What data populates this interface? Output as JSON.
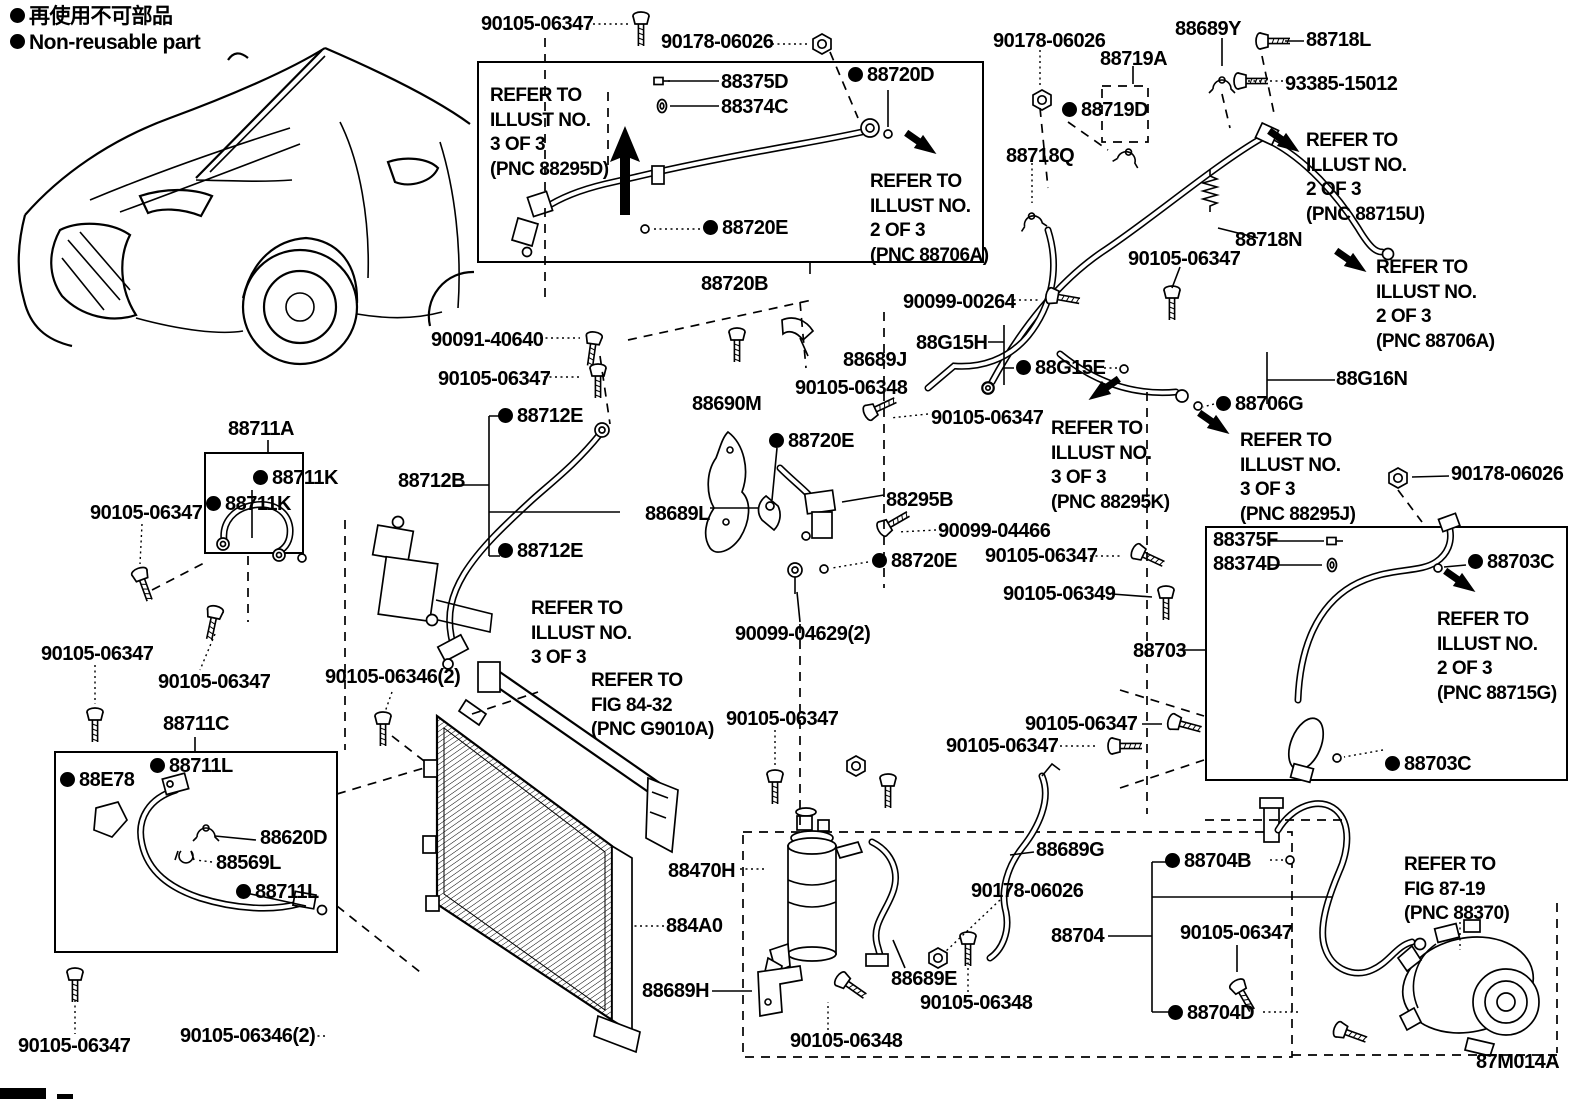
{
  "figure": {
    "figure_code": "87M014A",
    "description_visible": false
  },
  "colors": {
    "ink": "#000000",
    "paper": "#ffffff"
  },
  "legend": {
    "marker": "non-reusable-dot",
    "jp": "再使用不可部品",
    "en": "Non-reusable part"
  },
  "labels": [
    {
      "t": "再使用不可部品",
      "x": 10,
      "y": 6,
      "b": 1,
      "s": 21,
      "k": "legend-jp"
    },
    {
      "t": "Non-reusable part",
      "x": 10,
      "y": 32,
      "b": 1,
      "s": 21,
      "k": "legend-en"
    },
    {
      "t": "90105-06347",
      "x": 481,
      "y": 14
    },
    {
      "t": "90178-06026",
      "x": 661,
      "y": 32
    },
    {
      "t": "REFER TO\nILLUST NO.\n3 OF 3\n(PNC 88295D)",
      "x": 490,
      "y": 84,
      "m": 1,
      "s": 19,
      "k": "refer-note"
    },
    {
      "t": "88375D",
      "x": 721,
      "y": 72
    },
    {
      "t": "88374C",
      "x": 721,
      "y": 97
    },
    {
      "t": "88720D",
      "x": 848,
      "y": 65,
      "b": 1
    },
    {
      "t": "88720E",
      "x": 703,
      "y": 218,
      "b": 1
    },
    {
      "t": "REFER TO\nILLUST NO.\n2 OF 3\n(PNC 88706A)",
      "x": 870,
      "y": 170,
      "m": 1,
      "s": 19,
      "k": "refer-note"
    },
    {
      "t": "88720B",
      "x": 701,
      "y": 274
    },
    {
      "t": "90178-06026",
      "x": 993,
      "y": 31
    },
    {
      "t": "88719A",
      "x": 1100,
      "y": 49
    },
    {
      "t": "88719D",
      "x": 1062,
      "y": 100,
      "b": 1
    },
    {
      "t": "88689Y",
      "x": 1175,
      "y": 19
    },
    {
      "t": "88718L",
      "x": 1306,
      "y": 30
    },
    {
      "t": "93385-15012",
      "x": 1285,
      "y": 74
    },
    {
      "t": "88718Q",
      "x": 1006,
      "y": 146
    },
    {
      "t": "REFER TO\nILLUST NO.\n2 OF 3\n(PNC 88715U)",
      "x": 1306,
      "y": 129,
      "m": 1,
      "s": 19,
      "k": "refer-note"
    },
    {
      "t": "88718N",
      "x": 1235,
      "y": 230
    },
    {
      "t": "90105-06347",
      "x": 1128,
      "y": 249
    },
    {
      "t": "REFER TO\nILLUST NO.\n2 OF 3\n(PNC 88706A)",
      "x": 1376,
      "y": 256,
      "m": 1,
      "s": 19,
      "k": "refer-note"
    },
    {
      "t": "90099-00264",
      "x": 903,
      "y": 292
    },
    {
      "t": "90091-40640",
      "x": 431,
      "y": 330
    },
    {
      "t": "90105-06347",
      "x": 438,
      "y": 369
    },
    {
      "t": "88711A",
      "x": 228,
      "y": 419
    },
    {
      "t": "88711K",
      "x": 253,
      "y": 468,
      "b": 1
    },
    {
      "t": "88711K",
      "x": 206,
      "y": 494,
      "b": 1
    },
    {
      "t": "90105-06347",
      "x": 90,
      "y": 503
    },
    {
      "t": "88712B",
      "x": 398,
      "y": 471
    },
    {
      "t": "88712E",
      "x": 498,
      "y": 406,
      "b": 1
    },
    {
      "t": "88712E",
      "x": 498,
      "y": 541,
      "b": 1
    },
    {
      "t": "88690M",
      "x": 692,
      "y": 394
    },
    {
      "t": "88720E",
      "x": 769,
      "y": 431,
      "b": 1
    },
    {
      "t": "88689J",
      "x": 843,
      "y": 350
    },
    {
      "t": "90105-06348",
      "x": 795,
      "y": 378
    },
    {
      "t": "88G15H",
      "x": 916,
      "y": 333
    },
    {
      "t": "88G15E",
      "x": 1016,
      "y": 358,
      "b": 1
    },
    {
      "t": "90105-06347",
      "x": 931,
      "y": 408
    },
    {
      "t": "REFER TO\nILLUST NO.\n3 OF 3\n(PNC 88295K)",
      "x": 1051,
      "y": 417,
      "m": 1,
      "s": 19,
      "k": "refer-note"
    },
    {
      "t": "88G16N",
      "x": 1336,
      "y": 369
    },
    {
      "t": "88706G",
      "x": 1216,
      "y": 394,
      "b": 1
    },
    {
      "t": "REFER TO\nILLUST NO.\n3 OF 3\n(PNC 88295J)",
      "x": 1240,
      "y": 429,
      "m": 1,
      "s": 19,
      "k": "refer-note"
    },
    {
      "t": "90178-06026",
      "x": 1451,
      "y": 464
    },
    {
      "t": "88689L",
      "x": 645,
      "y": 504
    },
    {
      "t": "88295B",
      "x": 886,
      "y": 490
    },
    {
      "t": "90099-04466",
      "x": 938,
      "y": 521
    },
    {
      "t": "90105-06347",
      "x": 985,
      "y": 546
    },
    {
      "t": "88720E",
      "x": 872,
      "y": 551,
      "b": 1
    },
    {
      "t": "90105-06349",
      "x": 1003,
      "y": 584
    },
    {
      "t": "90099-04629(2)",
      "x": 735,
      "y": 624
    },
    {
      "t": "REFER TO\nILLUST NO.\n3 OF 3",
      "x": 531,
      "y": 597,
      "m": 1,
      "s": 19,
      "k": "refer-note"
    },
    {
      "t": "88703",
      "x": 1133,
      "y": 641
    },
    {
      "t": "88375F",
      "x": 1213,
      "y": 530
    },
    {
      "t": "88374D",
      "x": 1213,
      "y": 554
    },
    {
      "t": "88703C",
      "x": 1468,
      "y": 552,
      "b": 1
    },
    {
      "t": "REFER TO\nILLUST NO.\n2 OF 3\n(PNC 88715G)",
      "x": 1437,
      "y": 608,
      "m": 1,
      "s": 19,
      "k": "refer-note"
    },
    {
      "t": "88703C",
      "x": 1385,
      "y": 754,
      "b": 1
    },
    {
      "t": "90105-06347",
      "x": 41,
      "y": 644
    },
    {
      "t": "90105-06347",
      "x": 158,
      "y": 672
    },
    {
      "t": "88711C",
      "x": 163,
      "y": 714
    },
    {
      "t": "88E78",
      "x": 60,
      "y": 770,
      "b": 1
    },
    {
      "t": "88711L",
      "x": 150,
      "y": 756,
      "b": 1
    },
    {
      "t": "88620D",
      "x": 260,
      "y": 828
    },
    {
      "t": "88569L",
      "x": 216,
      "y": 853
    },
    {
      "t": "88711L",
      "x": 236,
      "y": 882,
      "b": 1
    },
    {
      "t": "90105-06347",
      "x": 18,
      "y": 1036
    },
    {
      "t": "90105-06346(2)",
      "x": 325,
      "y": 667
    },
    {
      "t": "REFER TO\nFIG 84-32\n(PNC G9010A)",
      "x": 591,
      "y": 669,
      "m": 1,
      "s": 19,
      "k": "refer-note"
    },
    {
      "t": "REFER TO\nFIG 87-19\n(PNC 88370)",
      "x": 1404,
      "y": 853,
      "m": 1,
      "s": 19,
      "k": "refer-note"
    },
    {
      "t": "90105-06346(2)",
      "x": 180,
      "y": 1026
    },
    {
      "t": "88470H",
      "x": 668,
      "y": 861
    },
    {
      "t": "884A0",
      "x": 666,
      "y": 916
    },
    {
      "t": "88689H",
      "x": 642,
      "y": 981
    },
    {
      "t": "90105-06348",
      "x": 790,
      "y": 1031
    },
    {
      "t": "88689E",
      "x": 891,
      "y": 969
    },
    {
      "t": "90105-06348",
      "x": 920,
      "y": 993
    },
    {
      "t": "90178-06026",
      "x": 971,
      "y": 881
    },
    {
      "t": "88689G",
      "x": 1036,
      "y": 840
    },
    {
      "t": "90105-06347",
      "x": 726,
      "y": 709
    },
    {
      "t": "90105-06347",
      "x": 946,
      "y": 736
    },
    {
      "t": "90105-06347",
      "x": 1025,
      "y": 714
    },
    {
      "t": "88704",
      "x": 1051,
      "y": 926
    },
    {
      "t": "88704B",
      "x": 1165,
      "y": 851,
      "b": 1
    },
    {
      "t": "90105-06347",
      "x": 1180,
      "y": 923
    },
    {
      "t": "88704D",
      "x": 1168,
      "y": 1003,
      "b": 1
    },
    {
      "t": "87M014A",
      "x": 1476,
      "y": 1052,
      "k": "figure-code"
    }
  ]
}
